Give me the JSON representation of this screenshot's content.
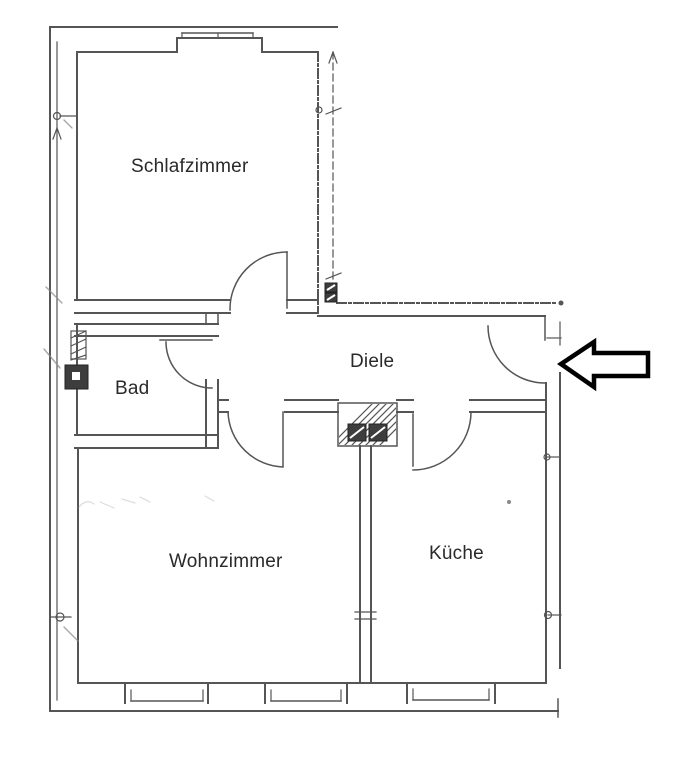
{
  "floorplan": {
    "rooms": {
      "schlafzimmer": {
        "label": "Schlafzimmer"
      },
      "bad": {
        "label": "Bad"
      },
      "diele": {
        "label": "Diele"
      },
      "wohnzimmer": {
        "label": "Wohnzimmer"
      },
      "kueche": {
        "label": "Küche"
      }
    },
    "icons": {
      "entrance_arrow": "left-arrow"
    },
    "colors": {
      "wall": "#555555",
      "label": "#2a2a2a",
      "arrow": "#000000",
      "background": "#ffffff",
      "pencil": "#8a8a8a"
    }
  }
}
